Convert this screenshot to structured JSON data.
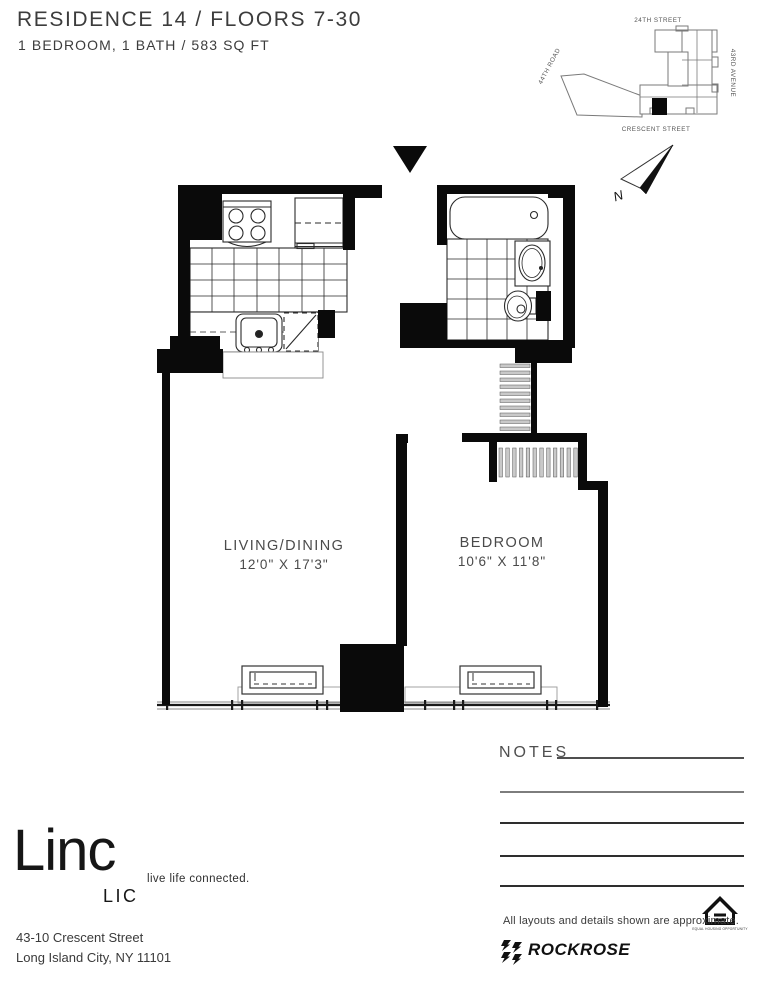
{
  "header": {
    "title": "RESIDENCE 14  /  FLOORS 7-30",
    "subtitle": "1 BEDROOM, 1 BATH  /  583 SQ FT"
  },
  "site_map": {
    "street_top": "24TH STREET",
    "street_right": "43RD AVENUE",
    "street_bottom": "CRESCENT STREET",
    "street_left": "44TH ROAD",
    "north_label": "N"
  },
  "floor_plan": {
    "living": {
      "name": "LIVING/DINING",
      "dims": "12'0\" X 17'3\""
    },
    "bedroom": {
      "name": "BEDROOM",
      "dims": "10'6\" X 11'8\""
    }
  },
  "notes": {
    "label": "NOTES",
    "blank_line_count": 4
  },
  "footer": {
    "logo": {
      "name": "Linc",
      "sub": "LIC",
      "tagline": "live life connected."
    },
    "address_line1": "43-10 Crescent Street",
    "address_line2": "Long Island City, NY 11101",
    "disclaimer": "All layouts and details shown are approximate.",
    "brand": "ROCKROSE",
    "equal_housing_label": "EQUAL HOUSING OPPORTUNITY"
  },
  "colors": {
    "ink": "#0a0a0a",
    "text_gray": "#3d3d3d",
    "line_gray": "#777777"
  }
}
